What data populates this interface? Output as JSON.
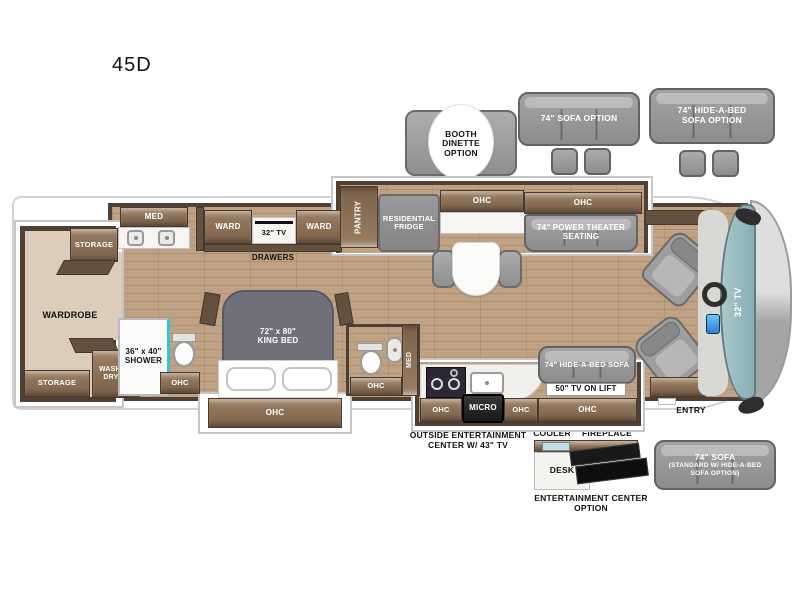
{
  "title": "45D",
  "colors": {
    "wall": "#503f33",
    "cabinet": "#8a7155",
    "floor_wood": "#b79a7d",
    "carpet": "#dccdbb",
    "furniture_gray": "#9a9a9a",
    "windshield_teal": "#8fb5ba",
    "shower_accent": "#2fc4d6",
    "dash_accent_blue": "#4aa7e8"
  },
  "labels": {
    "booth_option": "BOOTH\nDINETTE\nOPTION",
    "sofa_option": "74\" SOFA OPTION",
    "hab_sofa_option": "74\" HIDE-A-BED\nSOFA OPTION",
    "storage": "STORAGE",
    "wardrobe": "WARDROBE",
    "washer_dryer": "WASHER/\nDRYER",
    "med": "MED",
    "shower": "36\" x 40\"\nSHOWER",
    "ohc": "OHC",
    "ward": "WARD",
    "tv32_bedroom": "32\" TV",
    "drawers": "DRAWERS",
    "king_bed": "72\" x 80\"\nKING BED",
    "pantry": "PANTRY",
    "fridge": "RESIDENTIAL\nFRIDGE",
    "theater_seating": "74\" POWER THEATER\nSEATING",
    "hab_sofa": "74\" HIDE-A-BED SOFA",
    "tv_lift": "50\" TV ON LIFT",
    "micro": "MICRO",
    "outside_ent": "OUTSIDE ENTERTAINMENT\nCENTER W/ 43\" TV",
    "cooler": "COOLER",
    "fireplace": "FIREPLACE",
    "desk": "DESK",
    "ent_center_option": "ENTERTAINMENT CENTER\nOPTION",
    "sofa_std_title": "74\" SOFA",
    "sofa_std_sub": "(STANDARD W/ HIDE-A-BED\nSOFA OPTION)",
    "tv32_front": "32\" TV",
    "entry": "ENTRY"
  }
}
